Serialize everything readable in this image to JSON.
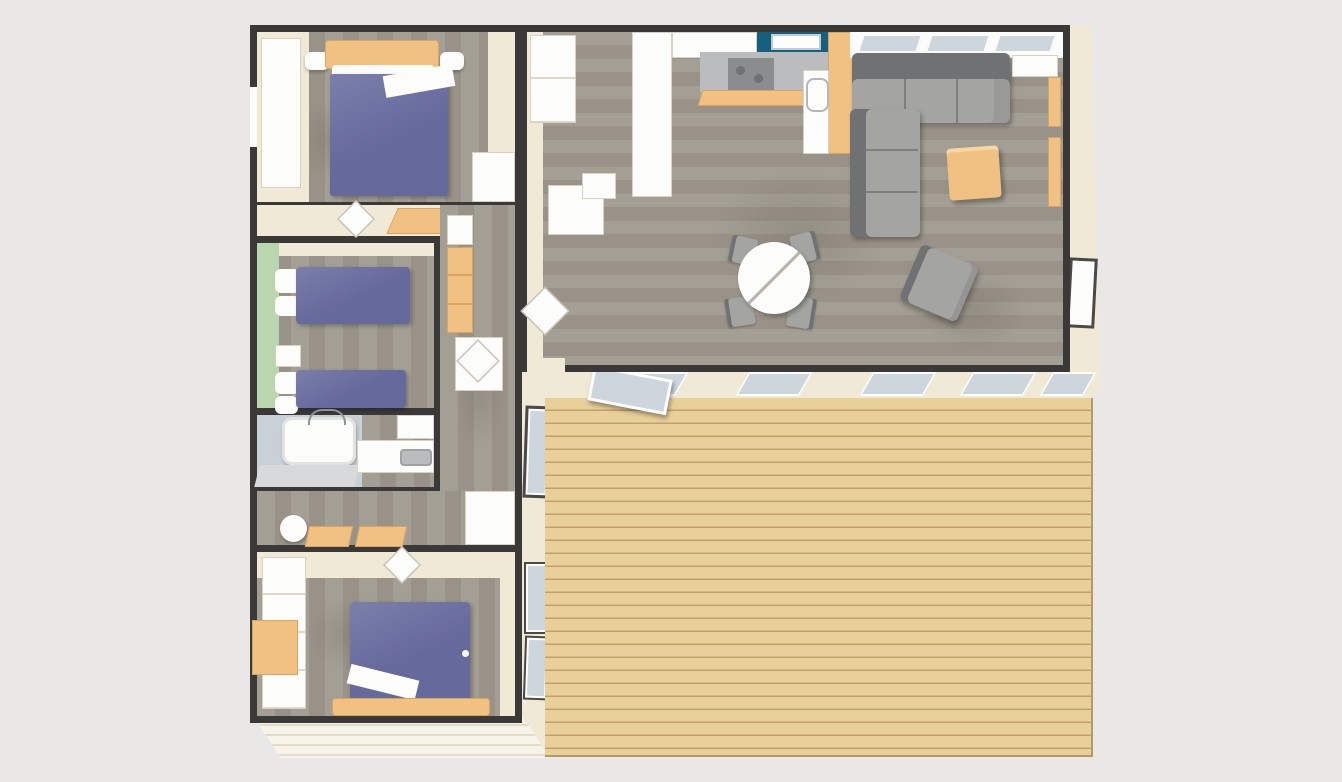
{
  "scene": {
    "name": "holiday-lodge-floor-plan-top-down",
    "view": "top-down-3d-render",
    "rooms": [
      {
        "id": "master-bedroom",
        "contents": [
          "double-bed-blue-duvet",
          "wood-headboard",
          "bedside-lamps",
          "wardrobe",
          "window"
        ]
      },
      {
        "id": "hallway-top",
        "contents": [
          "open-door",
          "wood-floor-patch"
        ]
      },
      {
        "id": "twin-bedroom",
        "contents": [
          "twin-bed-1",
          "twin-bed-2",
          "green-accent-wall",
          "nightstand",
          "wardrobe-orange"
        ]
      },
      {
        "id": "bathroom",
        "contents": [
          "bathtub",
          "vanity",
          "washbasin-counter",
          "cabinet"
        ]
      },
      {
        "id": "inner-hallway",
        "contents": [
          "round-stool",
          "bench-seat-1",
          "bench-seat-2"
        ]
      },
      {
        "id": "double-bedroom-2",
        "contents": [
          "double-bed-blue-duvet",
          "wood-footboard",
          "closet",
          "wood-shelf",
          "open-door"
        ]
      },
      {
        "id": "entry-hall",
        "contents": [
          "closets",
          "open-door",
          "storage-block"
        ]
      },
      {
        "id": "kitchen",
        "contents": [
          "white-cabinet-column",
          "worktop",
          "teal-sink-counter",
          "sink",
          "cooktop",
          "wood-edge-strip",
          "fridge-cabinet",
          "basin-unit"
        ]
      },
      {
        "id": "living-room",
        "contents": [
          "corner-sofa",
          "coffee-table",
          "side-table",
          "wall-shelves",
          "window-band",
          "armchair"
        ]
      },
      {
        "id": "dining-area",
        "contents": [
          "round-table",
          "dining-chair-nw",
          "dining-chair-sw",
          "dining-chair-ne",
          "dining-chair-se"
        ]
      },
      {
        "id": "wooden-deck",
        "contents": [
          "plank-flooring",
          "sliding-glass-doors",
          "open-sliding-door-leaf",
          "side-windows"
        ]
      }
    ]
  },
  "colors": {
    "bg": "#e9e8e6",
    "wall": "#3a3938",
    "cream": "#f0e9d6",
    "cream_light": "#f7f3e8",
    "white": "#fcfcfb",
    "floor_a": "#a49f94",
    "floor_b": "#989288",
    "deck": "#e9cf99",
    "deck_line": "#c2a168",
    "bed": "#66699b",
    "bed_light": "#7a7fab",
    "wood": "#f0c183",
    "wood_dark": "#d9a55e",
    "sofa": "#a4a4a2",
    "sofa_dark": "#707172",
    "green": "#b9d6ae",
    "bath": "#c8d1d7",
    "teal": "#15607f",
    "counter": "#babcbd",
    "stove": "#8a8c8d",
    "glass": "#cdd6dc"
  }
}
